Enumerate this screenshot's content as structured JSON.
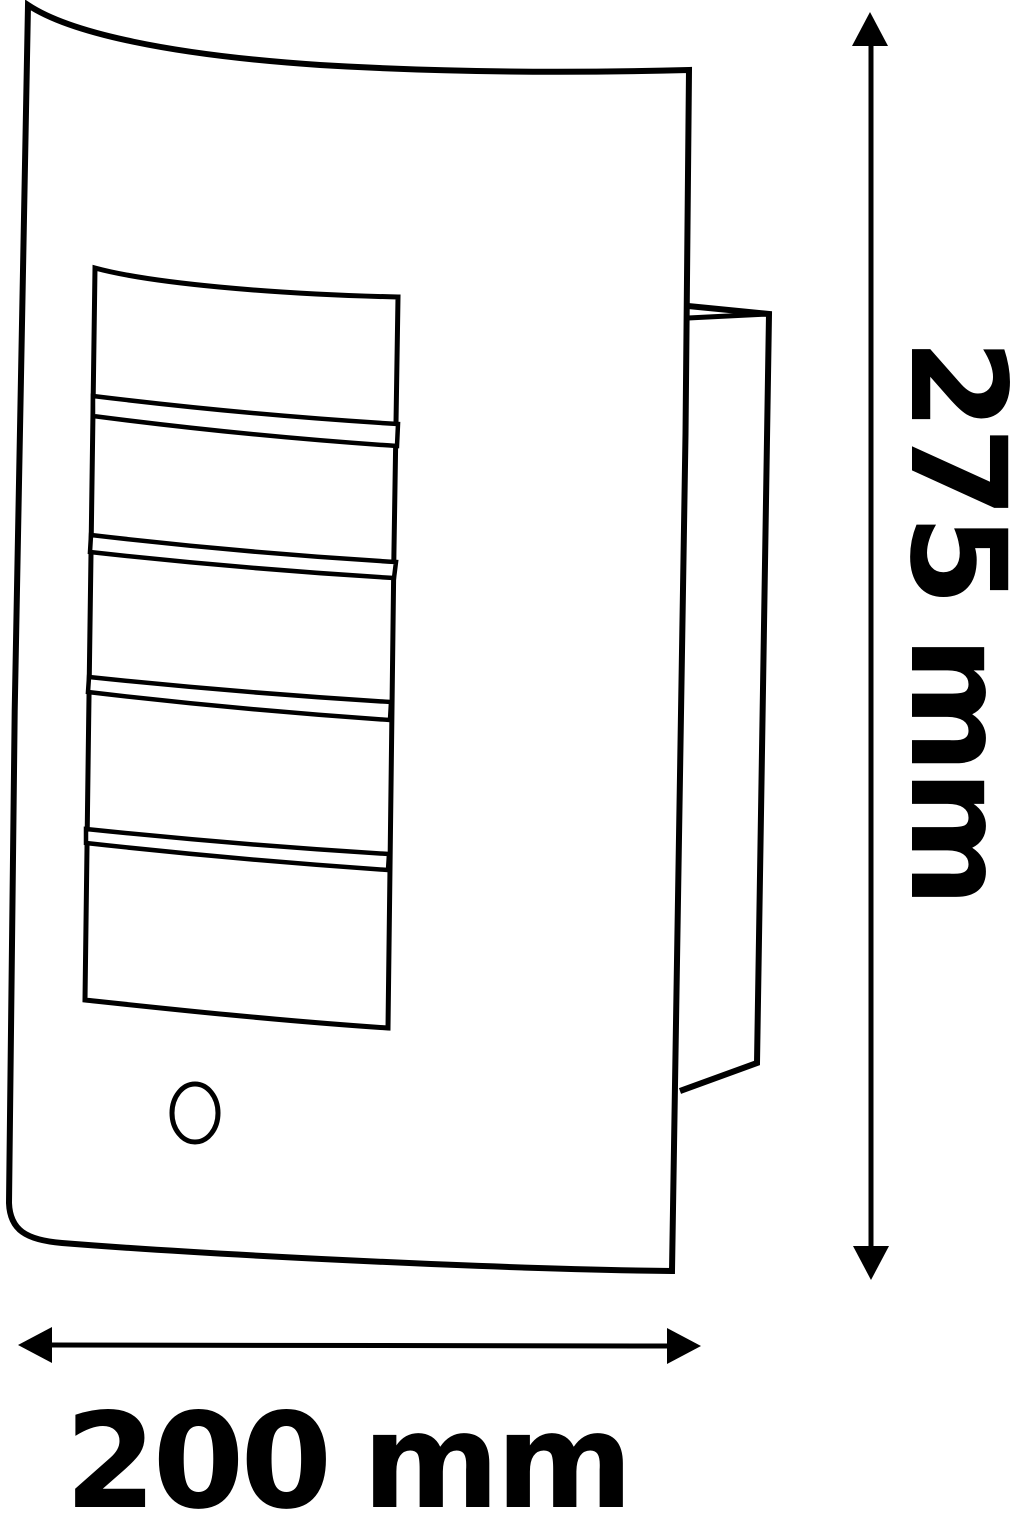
{
  "drawing": {
    "background_color": "#ffffff",
    "line_color": "#000000",
    "height_dimension": {
      "label": "275 mm",
      "value": 275,
      "unit": "mm"
    },
    "width_dimension": {
      "label": "200 mm",
      "value": 200,
      "unit": "mm"
    }
  }
}
